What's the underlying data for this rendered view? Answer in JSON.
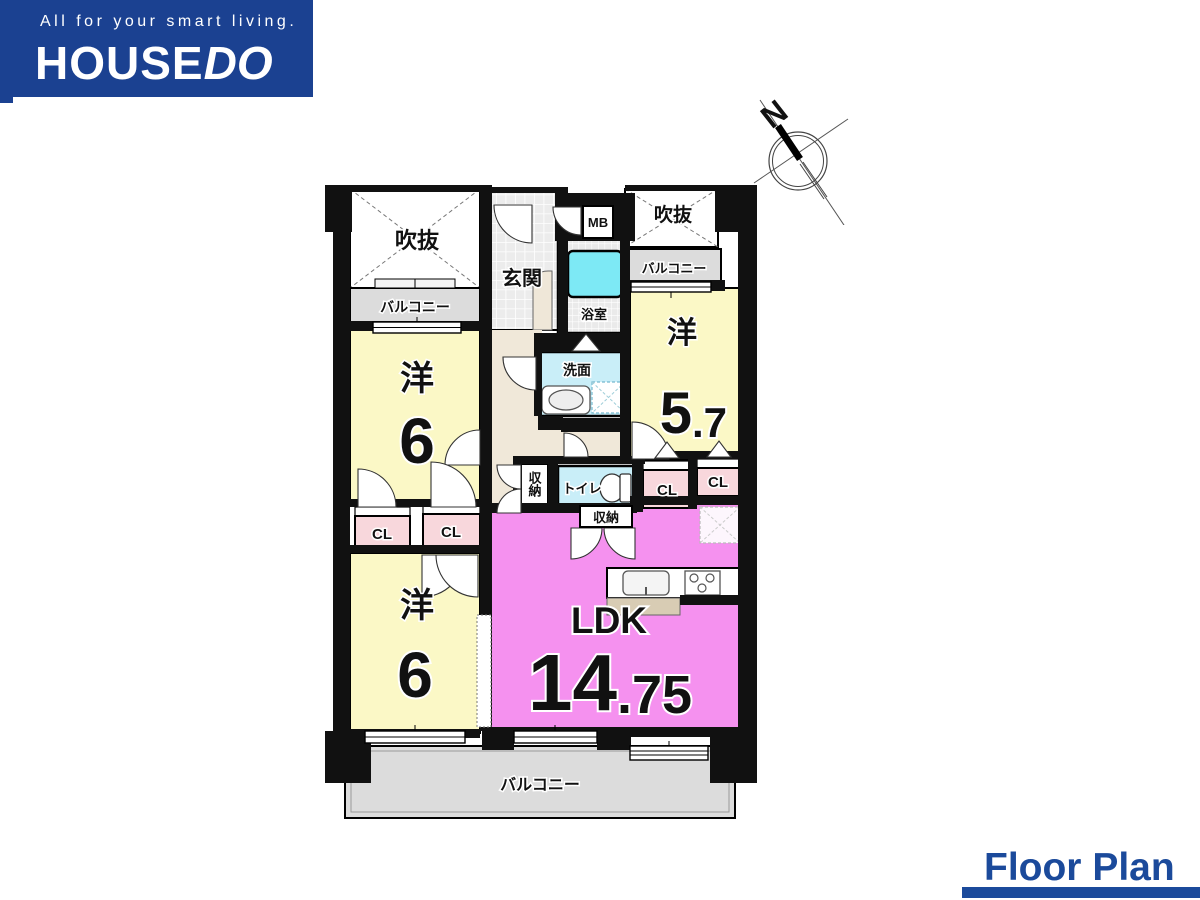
{
  "header": {
    "tagline": "All for your smart living.",
    "brand_main": "HOUSE",
    "brand_accent": "DO"
  },
  "compass": {
    "north_label": "N"
  },
  "footer": {
    "title": "Floor Plan"
  },
  "plan": {
    "labels": {
      "void": "吹抜",
      "balcony": "バルコニー",
      "entrance": "玄関",
      "meter_box": "MB",
      "bath": "浴室",
      "washroom": "洗面",
      "toilet": "トイレ",
      "storage": "収納",
      "closet": "CL"
    },
    "rooms": {
      "western_upper_left": {
        "kanji": "洋",
        "size": "6"
      },
      "western_lower_left": {
        "kanji": "洋",
        "size": "6"
      },
      "western_right": {
        "kanji": "洋",
        "size": "5.7",
        "size_main": "5",
        "size_frac": ".7"
      },
      "ldk": {
        "label": "LDK",
        "size": "14.75",
        "size_main": "14",
        "size_frac": ".75"
      }
    },
    "colors": {
      "brand_blue": "#1b4191",
      "room_yellow": "#fbf8c6",
      "ldk_pink": "#f591ef",
      "closet_pink": "#f8d7dc",
      "water_blue": "#c9eef8",
      "bathtub_cyan": "#7de9f5",
      "balcony_gray": "#dcdcdc",
      "hall_beige": "#f0e8d9",
      "counter_beige": "#d8ccb4"
    }
  }
}
